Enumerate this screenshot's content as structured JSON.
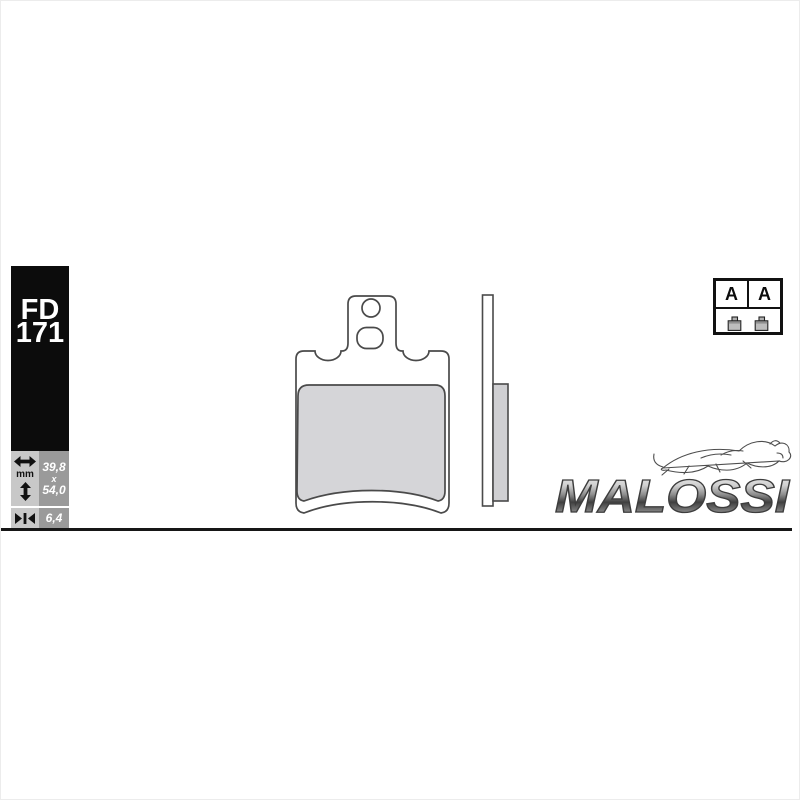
{
  "product_label": {
    "line1": "FD",
    "line2": "171"
  },
  "dimensions_panel": {
    "unit_label": "mm",
    "width_value": "39,8",
    "multiply_label": "x",
    "height_value": "54,0",
    "thickness_value": "6,4",
    "icons": {
      "width": "horizontal-double-arrow",
      "height": "vertical-double-arrow",
      "thickness": "inward-arrows-to-bar"
    }
  },
  "homologation_badge": {
    "left_letter": "A",
    "right_letter": "A",
    "icon": "brake-pad-symbol"
  },
  "brand": {
    "name": "MALOSSI",
    "emblem": "lion-sketch"
  },
  "colors": {
    "label_background": "#0c0c0c",
    "panel_light_gray": "#c8c8c8",
    "panel_dark_gray": "#9a9a9a",
    "friction_pad_gray": "#d5d5d8",
    "outline": "#4a4a4a",
    "baseline": "#161616"
  }
}
